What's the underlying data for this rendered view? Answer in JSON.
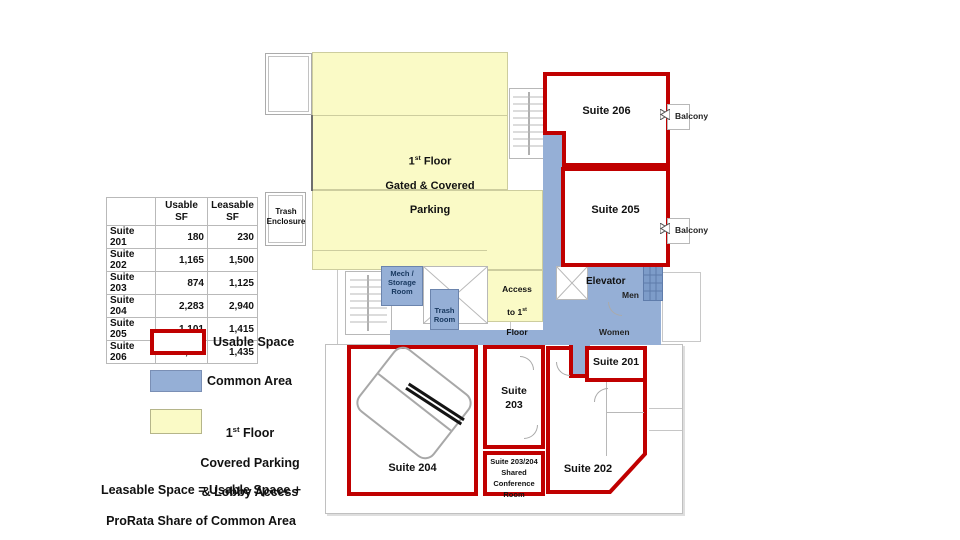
{
  "colors": {
    "usable_red": "#C00000",
    "common_blue": "#95AFD6",
    "parking_yellow": "#FAFAC6"
  },
  "table": {
    "col_usable": "Usable\nSF",
    "col_leasable": "Leasable\nSF",
    "rows": [
      {
        "name": "Suite 201",
        "usable": "180",
        "leasable": "230"
      },
      {
        "name": "Suite 202",
        "usable": "1,165",
        "leasable": "1,500"
      },
      {
        "name": "Suite 203",
        "usable": "874",
        "leasable": "1,125"
      },
      {
        "name": "Suite 204",
        "usable": "2,283",
        "leasable": "2,940"
      },
      {
        "name": "Suite 205",
        "usable": "1,101",
        "leasable": "1,415"
      },
      {
        "name": "Suite 206",
        "usable": "1,113",
        "leasable": "1,435"
      }
    ]
  },
  "legend": {
    "usable_label": "Usable Space",
    "common_label": "Common Area",
    "yellow_l1": {
      "pre": "1",
      "sup": "st",
      "post": " Floor"
    },
    "yellow_l2": "Covered Parking",
    "yellow_l3": "& Lobby Access",
    "formula_l1": "Leasable Space = Usable Space +",
    "formula_l2": "ProRata Share of Common Area"
  },
  "plan": {
    "parking_l1": {
      "pre": "1",
      "sup": "st",
      "post": " Floor"
    },
    "parking_l2": "Gated & Covered",
    "parking_l3": "Parking",
    "trash_enclosure": "Trash\nEnclosure",
    "mech_room": "Mech /\nStorage\nRoom",
    "trash_room": "Trash\nRoom",
    "access_l1": "Access",
    "access_l2": {
      "pre": "to 1",
      "sup": "st"
    },
    "access_l3": "Floor",
    "access_l4": "Lobby",
    "elevator": "Elevator",
    "men": "Men",
    "women": "Women",
    "balcony1": "Balcony",
    "balcony2": "Balcony",
    "suite201": "Suite 201",
    "suite202": "Suite 202",
    "suite203": "Suite\n203",
    "suite204": "Suite 204",
    "suite205": "Suite 205",
    "suite206": "Suite 206",
    "shared_conf": "Suite 203/204\nShared\nConference Room"
  }
}
